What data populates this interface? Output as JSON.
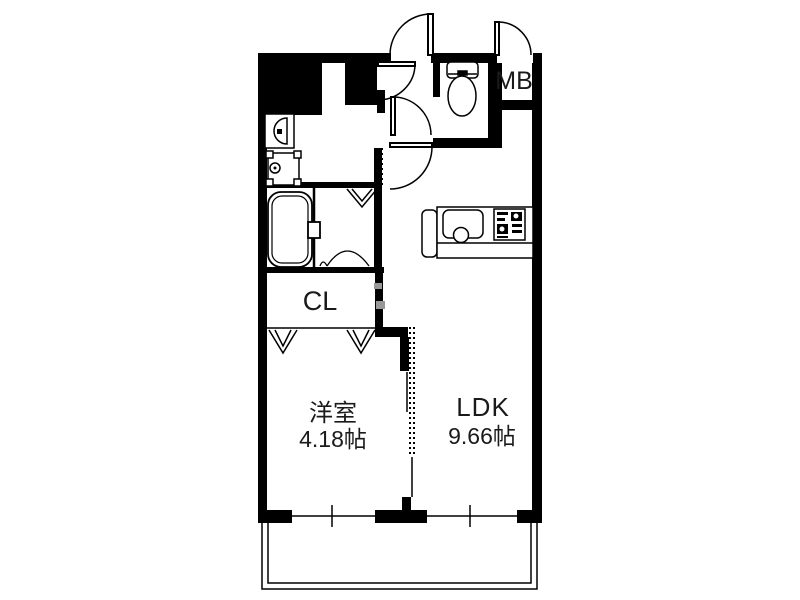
{
  "floor_plan": {
    "background_color": "#ffffff",
    "wall_color": "#000000",
    "closet_label_color": "#6e6e6e",
    "rooms": {
      "western_room": {
        "name": "洋室",
        "area": "4.18帖"
      },
      "ldk": {
        "name": "LDK",
        "area": "9.66帖"
      },
      "closet": {
        "abbr": "CL"
      },
      "meter_box": {
        "abbr": "MB"
      }
    },
    "fixtures": [
      "toilet",
      "washbasin",
      "washing-machine-pan",
      "bathtub",
      "kitchen-sink",
      "stove",
      "kitchen-counter"
    ],
    "features": [
      "entrance-door",
      "meter-box-door",
      "interior-hinged-doors",
      "folding-door-marks",
      "sliding-partition-dotted",
      "windows",
      "balcony"
    ]
  }
}
